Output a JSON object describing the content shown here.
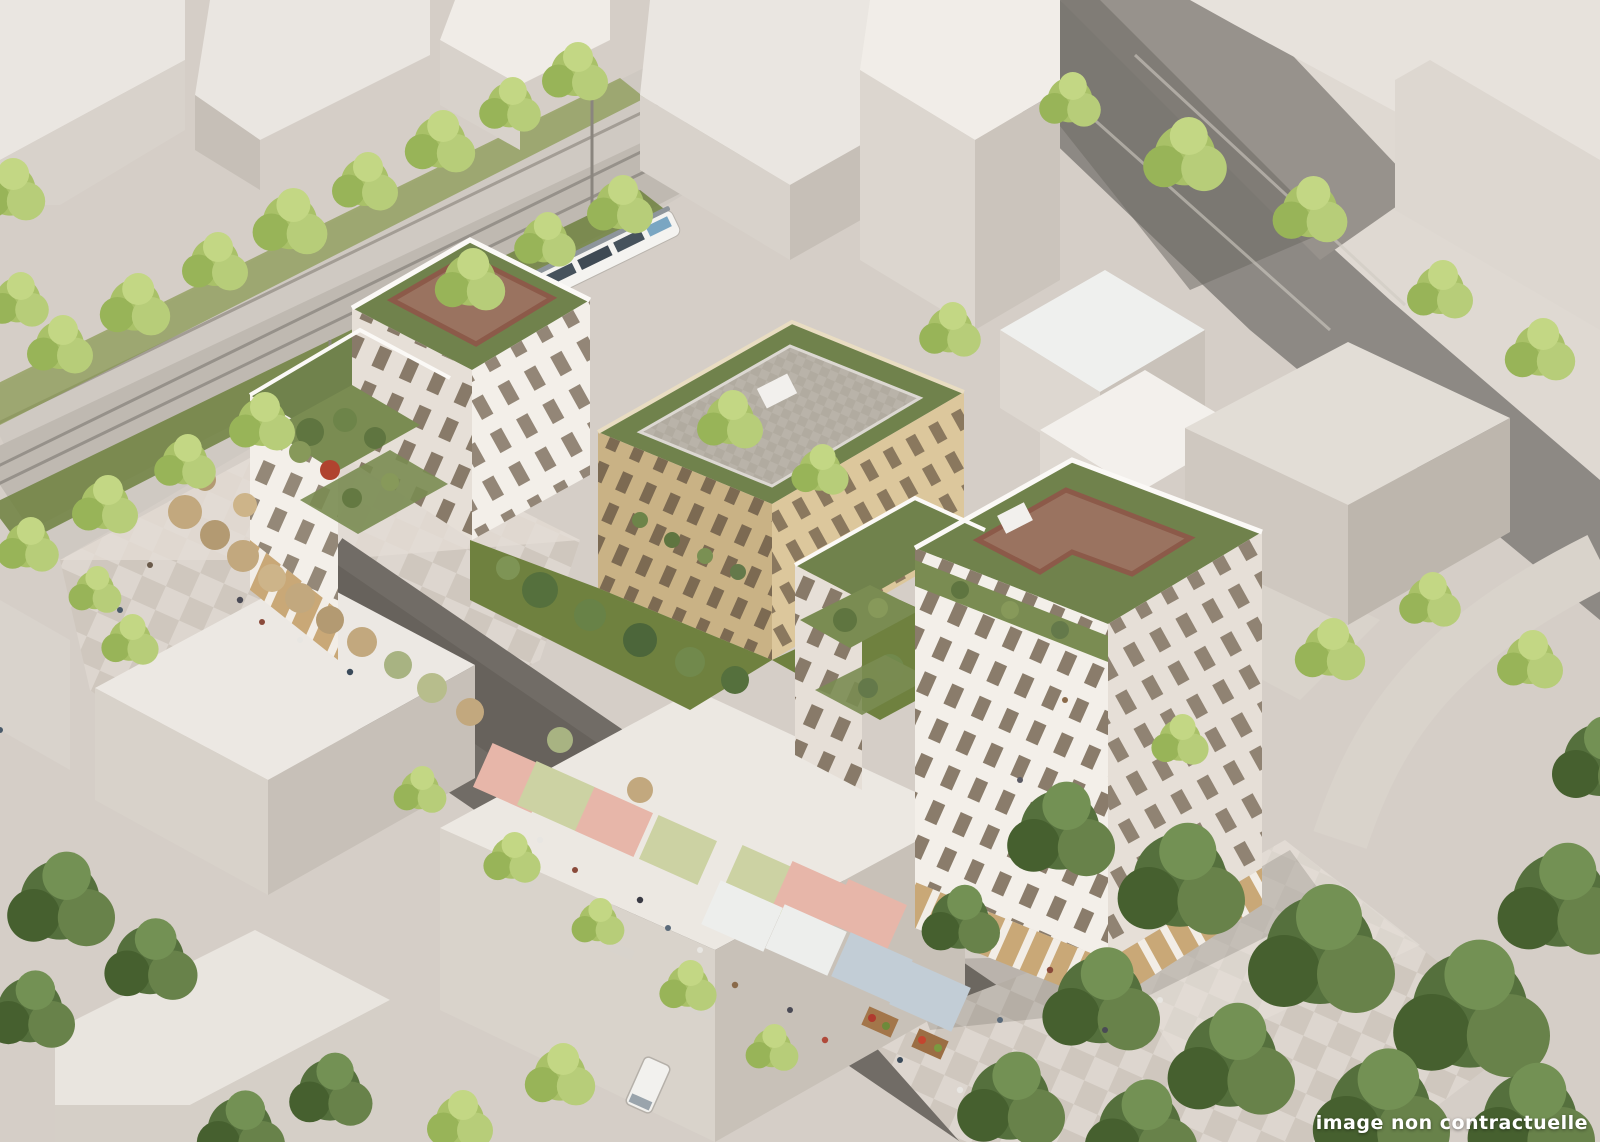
{
  "image": {
    "caption": "image non contractuelle",
    "subject": "aerial architectural rendering of a mixed-use residential block with green roofs, market street and tram"
  },
  "palette": {
    "ground": "#d5cec7",
    "paving-light": "#ddd6cf",
    "paving-dark": "#cfc7be",
    "asphalt": "#8d8984",
    "street-market": "#716c66",
    "block-top": "#eae6e1",
    "block-side-light": "#d8d2cb",
    "block-side-dark": "#c6bfb7",
    "white-facade": "#f3efe9",
    "white-facade-shade": "#e6dfd7",
    "window-dark": "#7b6c5a",
    "wood": "#c9a877",
    "tan-facade": "#dcc79c",
    "tan-facade-shade": "#c9b285",
    "roof-green": "#70824c",
    "terrace-brown": "#9a7360",
    "brick": "#8c5a49",
    "tree-light": "#a9c168",
    "tree-dark": "#55703d",
    "stall-pink": "#e7b6a9",
    "stall-sage": "#ccd2a3",
    "stall-white": "#edeeec",
    "stall-blue": "#c2cdd6",
    "umbrella-tan": "#c2a87e",
    "tram-blue": "#7aa6c2",
    "caption-color": "#ffffff"
  }
}
